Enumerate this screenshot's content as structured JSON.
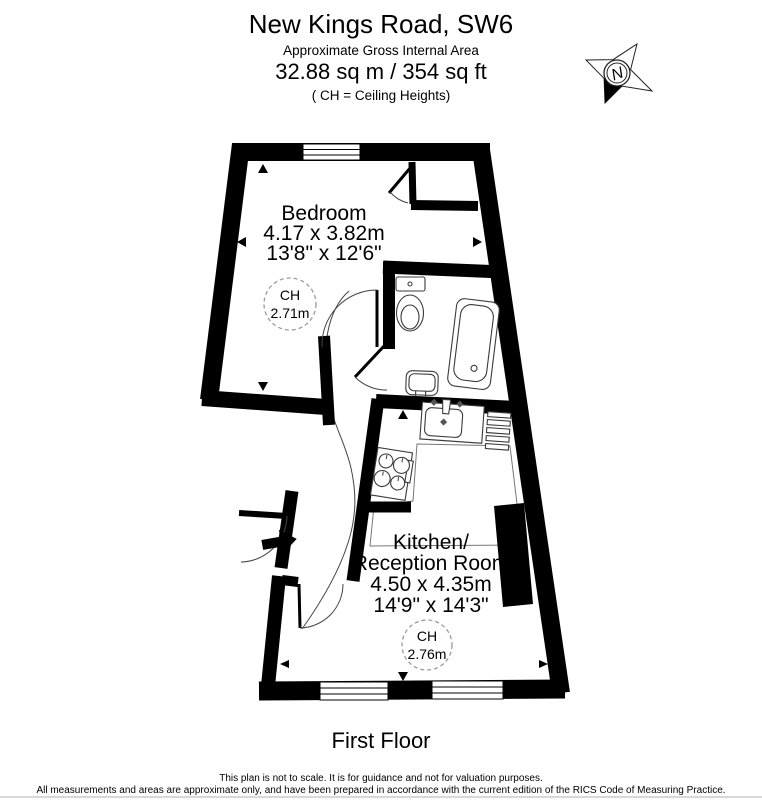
{
  "header": {
    "title": "New Kings Road, SW6",
    "subtitle": "Approximate Gross Internal Area",
    "area": "32.88 sq m / 354 sq ft",
    "ch_note": "( CH = Ceiling Heights)"
  },
  "compass": {
    "label": "N"
  },
  "rooms": {
    "bedroom": {
      "name": "Bedroom",
      "dimensions_metric": "4.17 x 3.82m",
      "dimensions_imperial": "13'8\" x 12'6\"",
      "ceiling_height_label": "CH",
      "ceiling_height": "2.71m"
    },
    "kitchen": {
      "name_line1": "Kitchen/",
      "name_line2": "Reception Room",
      "dimensions_metric": "4.50 x 4.35m",
      "dimensions_imperial": "14'9\" x 14'3\"",
      "ceiling_height_label": "CH",
      "ceiling_height": "2.76m"
    }
  },
  "floor_label": "First Floor",
  "footer": {
    "line1": "This plan is not to scale. It is for guidance and not for valuation purposes.",
    "line2": "All measurements and areas are approximate only, and have been prepared in accordance with the current edition of the RICS Code of Measuring Practice."
  },
  "colors": {
    "wall": "#000000",
    "background": "#ffffff",
    "dashed_circle": "#9a9a9a"
  }
}
